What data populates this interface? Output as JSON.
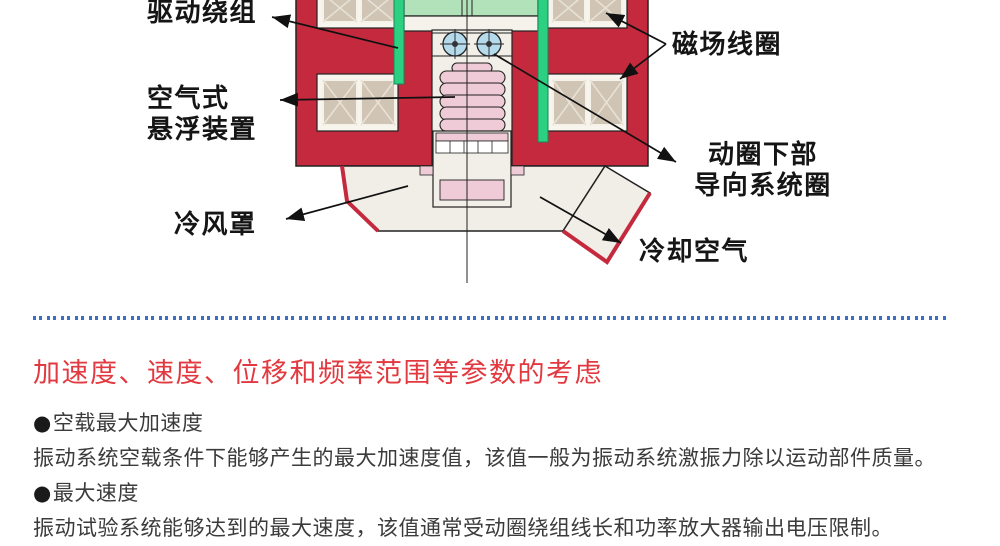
{
  "diagram": {
    "labels": {
      "drive_winding": "驱动绕组",
      "air_suspension_line1": "空气式",
      "air_suspension_line2": "悬浮装置",
      "cooling_hood": "冷风罩",
      "field_coil": "磁场线圈",
      "guide_line1": "动圈下部",
      "guide_line2": "导向系统圈",
      "cooling_air": "冷却空气"
    },
    "colors": {
      "body_red": "#c5293e",
      "table_green": "#b2e2ba",
      "winding_green": "#2bd181",
      "coil_tan": "#d0c4b4",
      "roller_blue": "#b5daeb",
      "bellows_pink": "#eecbd6",
      "ivory": "#f1efe8"
    }
  },
  "divider": {
    "color": "#3b6fc5"
  },
  "section": {
    "heading": "加速度、速度、位移和频率范围等参数的考虑",
    "heading_color": "#e2383f",
    "items": [
      {
        "bullet": "●",
        "title": "空载最大加速度",
        "body": "振动系统空载条件下能够产生的最大加速度值，该值一般为振动系统激振力除以运动部件质量。"
      },
      {
        "bullet": "●",
        "title": "最大速度",
        "body": "振动试验系统能够达到的最大速度，该值通常受动圈绕组线长和功率放大器输出电压限制。"
      }
    ]
  }
}
